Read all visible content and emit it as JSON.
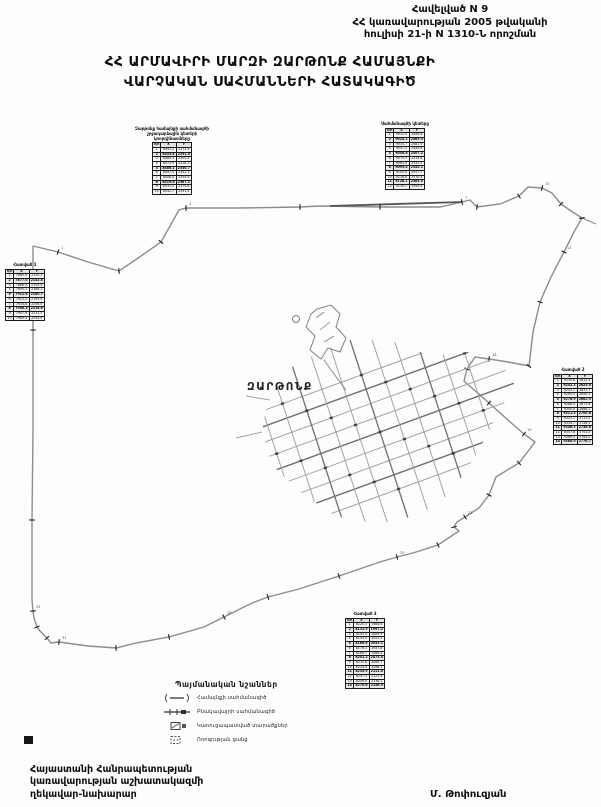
{
  "header_note": {
    "line1": "Հավելված N 9",
    "line2": "ՀՀ կառավարության 2005 թվականի",
    "line3": "հուլիսի 21-ի N 1310-Ն որոշման"
  },
  "title": {
    "line1": "ՀՀ ԱՐՄԱՎԻՐԻ ՄԱՐԶԻ ԶԱՐԹՈՆՔ ՀԱՄԱՅՆՔԻ",
    "line2": "ՎԱՐՉԱԿԱՆ ՍԱՀՄԱՆՆԵՐԻ ՀԱՏԱԿԱԳԻԾ"
  },
  "map": {
    "settlement_label": "ԶԱՐԹՈՆՔ",
    "line_color": "#8c8c8c",
    "tick_color": "#1f1f1f",
    "boundary": [
      [
        33,
        246
      ],
      [
        58,
        252
      ],
      [
        88,
        262
      ],
      [
        119,
        271
      ],
      [
        141,
        256
      ],
      [
        161,
        242
      ],
      [
        179,
        210
      ],
      [
        186,
        208
      ],
      [
        240,
        208
      ],
      [
        300,
        207
      ],
      [
        320,
        206
      ],
      [
        380,
        207
      ],
      [
        440,
        207
      ],
      [
        462,
        202
      ],
      [
        470,
        200
      ],
      [
        477,
        207
      ],
      [
        500,
        204
      ],
      [
        519,
        196
      ],
      [
        528,
        187
      ],
      [
        542,
        188
      ],
      [
        552,
        193
      ],
      [
        561,
        204
      ],
      [
        571,
        211
      ],
      [
        582,
        218
      ],
      [
        574,
        232
      ],
      [
        564,
        252
      ],
      [
        551,
        277
      ],
      [
        540,
        302
      ],
      [
        533,
        332
      ],
      [
        529,
        366
      ],
      [
        508,
        362
      ],
      [
        489,
        359
      ],
      [
        475,
        357
      ],
      [
        467,
        369
      ],
      [
        464,
        381
      ],
      [
        489,
        403
      ],
      [
        509,
        421
      ],
      [
        524,
        434
      ],
      [
        535,
        442
      ],
      [
        519,
        463
      ],
      [
        496,
        477
      ],
      [
        489,
        495
      ],
      [
        479,
        508
      ],
      [
        465,
        517
      ],
      [
        457,
        522
      ],
      [
        454,
        527
      ],
      [
        459,
        531
      ],
      [
        438,
        545
      ],
      [
        413,
        553
      ],
      [
        397,
        557
      ],
      [
        380,
        562
      ],
      [
        339,
        576
      ],
      [
        299,
        589
      ],
      [
        268,
        597
      ],
      [
        252,
        603
      ],
      [
        224,
        617
      ],
      [
        204,
        627
      ],
      [
        169,
        637
      ],
      [
        136,
        643
      ],
      [
        116,
        648
      ],
      [
        88,
        646
      ],
      [
        59,
        642
      ],
      [
        51,
        643
      ],
      [
        47,
        638
      ],
      [
        40,
        631
      ],
      [
        37,
        627
      ],
      [
        34,
        618
      ],
      [
        33,
        611
      ],
      [
        32,
        600
      ],
      [
        32,
        520
      ],
      [
        33,
        430
      ],
      [
        33,
        330
      ],
      [
        33,
        246
      ]
    ],
    "top_dark_segment": [
      330,
      206,
      462,
      202
    ],
    "corner_tail": [
      582,
      218,
      596,
      224
    ],
    "village_clip": [
      [
        262,
        432
      ],
      [
        268,
        398
      ],
      [
        290,
        368
      ],
      [
        320,
        352
      ],
      [
        355,
        338
      ],
      [
        395,
        342
      ],
      [
        430,
        356
      ],
      [
        468,
        352
      ],
      [
        500,
        362
      ],
      [
        515,
        385
      ],
      [
        497,
        415
      ],
      [
        478,
        452
      ],
      [
        452,
        492
      ],
      [
        420,
        515
      ],
      [
        378,
        524
      ],
      [
        335,
        516
      ],
      [
        300,
        492
      ],
      [
        272,
        465
      ]
    ],
    "grid": {
      "cx": 380,
      "cy": 432,
      "a1": -20,
      "a2": 72,
      "s1": 15,
      "n1": 9,
      "s2": 21,
      "n2": 11,
      "len1": 145,
      "len2": 98
    },
    "enclave": [
      [
        317,
        309
      ],
      [
        331,
        305
      ],
      [
        340,
        314
      ],
      [
        336,
        327
      ],
      [
        346,
        338
      ],
      [
        340,
        352
      ],
      [
        328,
        348
      ],
      [
        321,
        359
      ],
      [
        310,
        350
      ],
      [
        315,
        336
      ],
      [
        306,
        327
      ],
      [
        311,
        314
      ]
    ],
    "enclave_hatch": [
      [
        316,
        318,
        324,
        312
      ],
      [
        320,
        330,
        330,
        322
      ],
      [
        324,
        342,
        334,
        336
      ]
    ],
    "enclave_circle": [
      296,
      319,
      3.5
    ],
    "canal": [
      [
        324,
        360
      ],
      [
        334,
        374
      ],
      [
        346,
        390
      ]
    ],
    "tails": [
      [
        262,
        432,
        236,
        438
      ],
      [
        270,
        400,
        246,
        396
      ]
    ],
    "corner_mark": [
      24,
      736,
      9,
      8
    ]
  },
  "tables": [
    {
      "x": 133,
      "y": 127,
      "capw": 78,
      "caption": "Զարթոնք համայնքի սահմանագծի շրջադարձային կետերի կոորդինատները",
      "cols": [
        "հ/հ",
        "X",
        "Y"
      ],
      "rows": [
        [
          "1",
          "8441.2",
          "2273.5"
        ],
        [
          "2",
          "8453.8",
          "2291.0"
        ],
        [
          "3",
          "8460.3",
          "2305.4"
        ],
        [
          "4",
          "8472.9",
          "2318.2"
        ],
        [
          "5",
          "8486.1",
          "2330.7"
        ],
        [
          "6",
          "8497.4",
          "2342.3"
        ],
        [
          "7",
          "8508.0",
          "2355.9"
        ],
        [
          "8",
          "8519.6",
          "2367.1"
        ],
        [
          "9",
          "8531.2",
          "2379.8"
        ],
        [
          "10",
          "8542.7",
          "2391.4"
        ]
      ]
    },
    {
      "x": 377,
      "y": 122,
      "capw": 56,
      "caption": "Սահմանագծի կետերը",
      "cols": [
        "հ/հ",
        "X",
        "Y"
      ],
      "rows": [
        [
          "1",
          "9012.5",
          "2456.8"
        ],
        [
          "2",
          "9024.1",
          "2469.3"
        ],
        [
          "3",
          "9035.7",
          "2481.9"
        ],
        [
          "4",
          "9047.2",
          "2494.6"
        ],
        [
          "5",
          "9058.8",
          "2507.2"
        ],
        [
          "6",
          "9070.3",
          "2519.8"
        ],
        [
          "7",
          "9081.9",
          "2532.5"
        ],
        [
          "8",
          "9093.4",
          "2545.1"
        ],
        [
          "9",
          "9105.0",
          "2557.7"
        ],
        [
          "10",
          "9116.6",
          "2570.4"
        ],
        [
          "11",
          "9128.1",
          "2583.0"
        ],
        [
          "12",
          "9139.7",
          "2595.6"
        ]
      ]
    },
    {
      "x": 5,
      "y": 263,
      "capw": 30,
      "caption": "Հատված 1",
      "cols": [
        "հ/հ",
        "X",
        "Y"
      ],
      "rows": [
        [
          "1",
          "7865.4",
          "2130.2"
        ],
        [
          "2",
          "7877.0",
          "2142.8"
        ],
        [
          "3",
          "7888.5",
          "2155.5"
        ],
        [
          "4",
          "7900.1",
          "2168.1"
        ],
        [
          "5",
          "7911.6",
          "2180.7"
        ],
        [
          "6",
          "7923.2",
          "2193.4"
        ],
        [
          "7",
          "7934.8",
          "2206.0"
        ],
        [
          "8",
          "7946.3",
          "2218.6"
        ],
        [
          "9",
          "7957.9",
          "2231.3"
        ],
        [
          "10",
          "7969.4",
          "2243.9"
        ]
      ]
    },
    {
      "x": 552,
      "y": 368,
      "capw": 42,
      "caption": "Հատված 2",
      "cols": [
        "հ/հ",
        "X",
        "Y"
      ],
      "rows": [
        [
          "1",
          "9230.6",
          "2612.4"
        ],
        [
          "2",
          "9242.2",
          "2625.0"
        ],
        [
          "3",
          "9253.7",
          "2637.7"
        ],
        [
          "4",
          "9265.3",
          "2650.3"
        ],
        [
          "5",
          "9276.9",
          "2662.9"
        ],
        [
          "6",
          "9288.4",
          "2675.6"
        ],
        [
          "7",
          "9300.0",
          "2688.2"
        ],
        [
          "8",
          "9311.5",
          "2700.8"
        ],
        [
          "9",
          "9323.1",
          "2713.5"
        ],
        [
          "10",
          "9334.7",
          "2726.1"
        ],
        [
          "11",
          "9346.2",
          "2738.8"
        ],
        [
          "12",
          "9357.8",
          "2751.4"
        ],
        [
          "13",
          "9369.3",
          "2764.0"
        ],
        [
          "14",
          "9380.9",
          "2776.7"
        ]
      ]
    },
    {
      "x": 343,
      "y": 612,
      "capw": 44,
      "caption": "Հատված 3",
      "cols": [
        "հ/հ",
        "X",
        "Y"
      ],
      "rows": [
        [
          "1",
          "8120.3",
          "1984.6"
        ],
        [
          "2",
          "8131.9",
          "1997.2"
        ],
        [
          "3",
          "8143.4",
          "2009.9"
        ],
        [
          "4",
          "8155.0",
          "2022.5"
        ],
        [
          "5",
          "8166.6",
          "2035.1"
        ],
        [
          "6",
          "8178.1",
          "2047.8"
        ],
        [
          "7",
          "8189.7",
          "2060.4"
        ],
        [
          "8",
          "8201.2",
          "2073.0"
        ],
        [
          "9",
          "8212.8",
          "2085.7"
        ],
        [
          "10",
          "8224.4",
          "2098.3"
        ],
        [
          "11",
          "8235.9",
          "2111.0"
        ],
        [
          "12",
          "8247.5",
          "2123.6"
        ],
        [
          "13",
          "8259.0",
          "2136.2"
        ],
        [
          "14",
          "8270.6",
          "2148.9"
        ]
      ]
    }
  ],
  "legend": {
    "title": "Պայմանական նշաններ",
    "items": [
      {
        "label": "Համայնքի սահմանագիծ"
      },
      {
        "label": "Բնակավայրի սահմանագիծ"
      },
      {
        "label": "Կառուցապատված տարածքներ"
      },
      {
        "label": "Ոռոգության ցանց"
      }
    ]
  },
  "footer": {
    "left1": "Հայաստանի Հանրապետության",
    "left2": "կառավարության աշխատակազմի",
    "left3": "ղեկավար-նախարար",
    "signature": "Մ. Թոփուզյան"
  }
}
